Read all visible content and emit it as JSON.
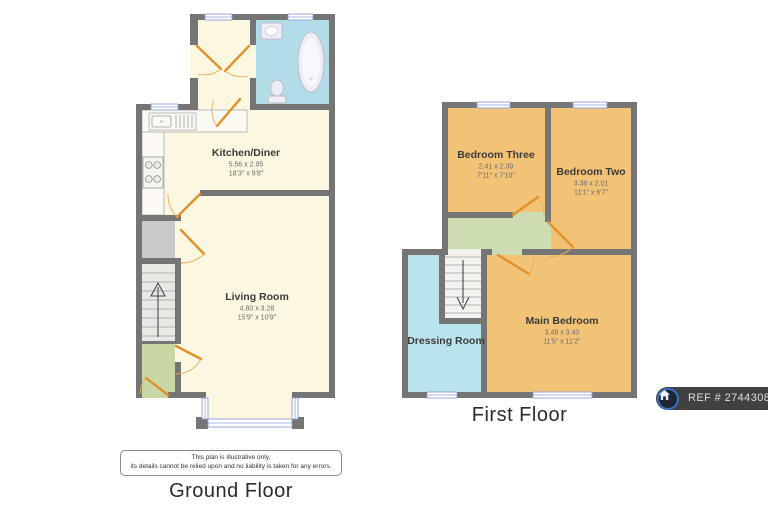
{
  "ground_floor": {
    "title": "Ground Floor",
    "rooms": {
      "kitchen_diner": {
        "name": "Kitchen/Diner",
        "metric": "5.56 x 2.95",
        "imperial": "18'3\" x 9'8\""
      },
      "living_room": {
        "name": "Living Room",
        "metric": "4.80 x 3.28",
        "imperial": "15'9\" x 10'9\""
      }
    }
  },
  "first_floor": {
    "title": "First Floor",
    "rooms": {
      "bedroom_three": {
        "name": "Bedroom Three",
        "metric": "2.41 x 2.39",
        "imperial": "7'11\" x 7'10\""
      },
      "bedroom_two": {
        "name": "Bedroom Two",
        "metric": "3.38 x 2.01",
        "imperial": "11'1\" x 6'7\""
      },
      "main_bedroom": {
        "name": "Main Bedroom",
        "metric": "3.48 x 3.40",
        "imperial": "11'5\" x 11'2\""
      },
      "dressing_room": {
        "name": "Dressing Room"
      }
    }
  },
  "disclaimer": {
    "line1": "This plan is illustrative only,",
    "line2": "its details cannot be relied upon and no liability is taken for any errors."
  },
  "ref_badge": {
    "label": "REF # 2744308",
    "logo": "onthemarket-house-icon"
  },
  "colors": {
    "wall_gray": "#757575",
    "room_cream": "#FCF7E1",
    "bedroom_orange": "#F2C377",
    "bathroom_blue": "#B2DDE8",
    "dressing_cyan": "#B9E4EE",
    "landing_green": "#CEDCB2",
    "porch_green": "#C9D7A5",
    "storage_gray": "#C9C9C9",
    "stairs_gray": "#E9E8E5",
    "door_orange": "#E0912C",
    "window_blue": "#8F9FD8",
    "badge_bg": "#414141",
    "logo_blue": "#3A6FC9"
  }
}
